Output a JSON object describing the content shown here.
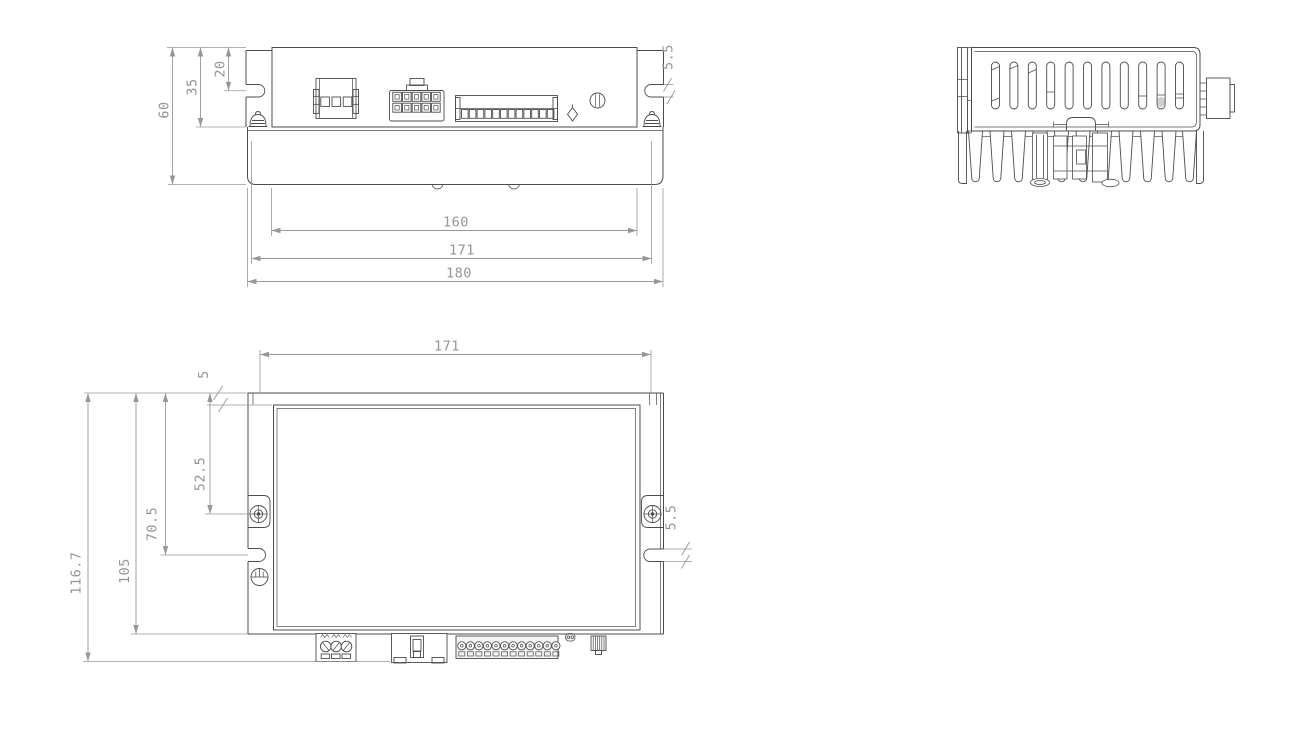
{
  "canvas": {
    "width": 1300,
    "height": 755,
    "background": "#ffffff"
  },
  "drawing": {
    "kind": "technical-drawing",
    "part_stroke": "#4c4c4c",
    "dim_stroke": "#979797",
    "views": {
      "front": {
        "name": "front-view",
        "dims": [
          {
            "label": "20",
            "line": [
              228.5,
              47.5,
              228.5,
              90.75
            ],
            "label_pos": [
              220.5,
              69
            ],
            "rot": -90,
            "exts": [
              [
                224,
                90.75,
                246,
                90.75
              ]
            ]
          },
          {
            "label": "35",
            "line": [
              200.5,
              47.5,
              200.5,
              127
            ],
            "label_pos": [
              192.5,
              87
            ],
            "rot": -90,
            "exts": [
              [
                196,
                127,
                246,
                127
              ]
            ]
          },
          {
            "label": "60",
            "line": [
              172.5,
              47.5,
              172.5,
              184.5
            ],
            "label_pos": [
              164.5,
              110
            ],
            "rot": -90,
            "exts": [
              [
                167,
                47.5,
                246,
                47.5
              ],
              [
                168,
                184.5,
                246,
                184.5
              ]
            ]
          },
          {
            "label": "160",
            "line": [
              271.5,
              230.5,
              637,
              230.5
            ],
            "label_pos": [
              456,
              222.5
            ],
            "rot": 0,
            "exts": [
              [
                271.5,
                188,
                271.5,
                236
              ],
              [
                637,
                188,
                637,
                236
              ]
            ]
          },
          {
            "label": "171",
            "line": [
              251.5,
              258.5,
              651.5,
              258.5
            ],
            "label_pos": [
              462,
              250.5
            ],
            "rot": 0,
            "exts": [
              [
                251.5,
                141,
                251.5,
                264
              ],
              [
                651.5,
                141,
                651.5,
                264
              ]
            ]
          },
          {
            "label": "180",
            "line": [
              247.5,
              281.5,
              663,
              281.5
            ],
            "label_pos": [
              459,
              273.5
            ],
            "rot": 0,
            "exts": [
              [
                247.5,
                188,
                247.5,
                287
              ],
              [
                663,
                188,
                663,
                287
              ]
            ]
          },
          {
            "label": "5.5",
            "label_pos": [
              668.5,
              57
            ],
            "rot": -90,
            "exts": [
              [
                663.5,
                84.5,
                673.5,
                84.5
              ],
              [
                663.5,
                97,
                673.5,
                97
              ]
            ],
            "slashes": [
              [
                663.5,
                91.5,
                671.5,
                78
              ],
              [
                667,
                104,
                675,
                90.5
              ]
            ]
          }
        ]
      },
      "side": {
        "name": "side-view",
        "dims": []
      },
      "top": {
        "name": "top-view",
        "dims": [
          {
            "label": "171",
            "line": [
              260,
              354.5,
              651,
              354.5
            ],
            "label_pos": [
              447,
              346.5
            ],
            "rot": 0,
            "exts": [
              [
                260,
                350,
                260,
                393
              ],
              [
                651,
                350,
                651,
                393
              ]
            ]
          },
          {
            "label": "5",
            "label_pos": [
              204,
              374.5
            ],
            "rot": -90,
            "exts": [
              [
                207,
                405,
                272,
                405
              ]
            ],
            "slashes": [
              [
                213.5,
                400,
                222.5,
                386
              ],
              [
                218.5,
                412,
                227.5,
                398
              ]
            ]
          },
          {
            "label": "52.5",
            "line": [
              210,
              393,
              210,
              514
            ],
            "label_pos": [
              200.5,
              474
            ],
            "rot": -90,
            "exts": [
              [
                205,
                514,
                251,
                514
              ]
            ]
          },
          {
            "label": "70.5",
            "line": [
              165.5,
              393,
              165.5,
              555
            ],
            "label_pos": [
              152.5,
              524
            ],
            "rot": -90,
            "exts": [
              [
                160.5,
                555,
                248,
                555
              ]
            ]
          },
          {
            "label": "105",
            "line": [
              136,
              393,
              136,
              634
            ],
            "label_pos": [
              125,
              571
            ],
            "rot": -90,
            "exts": [
              [
                131,
                634,
                248,
                634
              ]
            ]
          },
          {
            "label": "116.7",
            "line": [
              88,
              393,
              88,
              661.5
            ],
            "label_pos": [
              76.5,
              573
            ],
            "rot": -90,
            "exts": [
              [
                84,
                393,
                248,
                393
              ],
              [
                83,
                661.5,
                390,
                661.5
              ]
            ]
          },
          {
            "label": "5.5",
            "label_pos": [
              671.5,
              517.5
            ],
            "rot": -90,
            "exts": [
              [
                663.5,
                549,
                692,
                549
              ],
              [
                663.5,
                561.5,
                692,
                561.5
              ]
            ],
            "slashes": [
              [
                681.5,
                555.5,
                689.5,
                542
              ],
              [
                681.5,
                568.5,
                689.5,
                555
              ]
            ]
          }
        ]
      }
    }
  }
}
